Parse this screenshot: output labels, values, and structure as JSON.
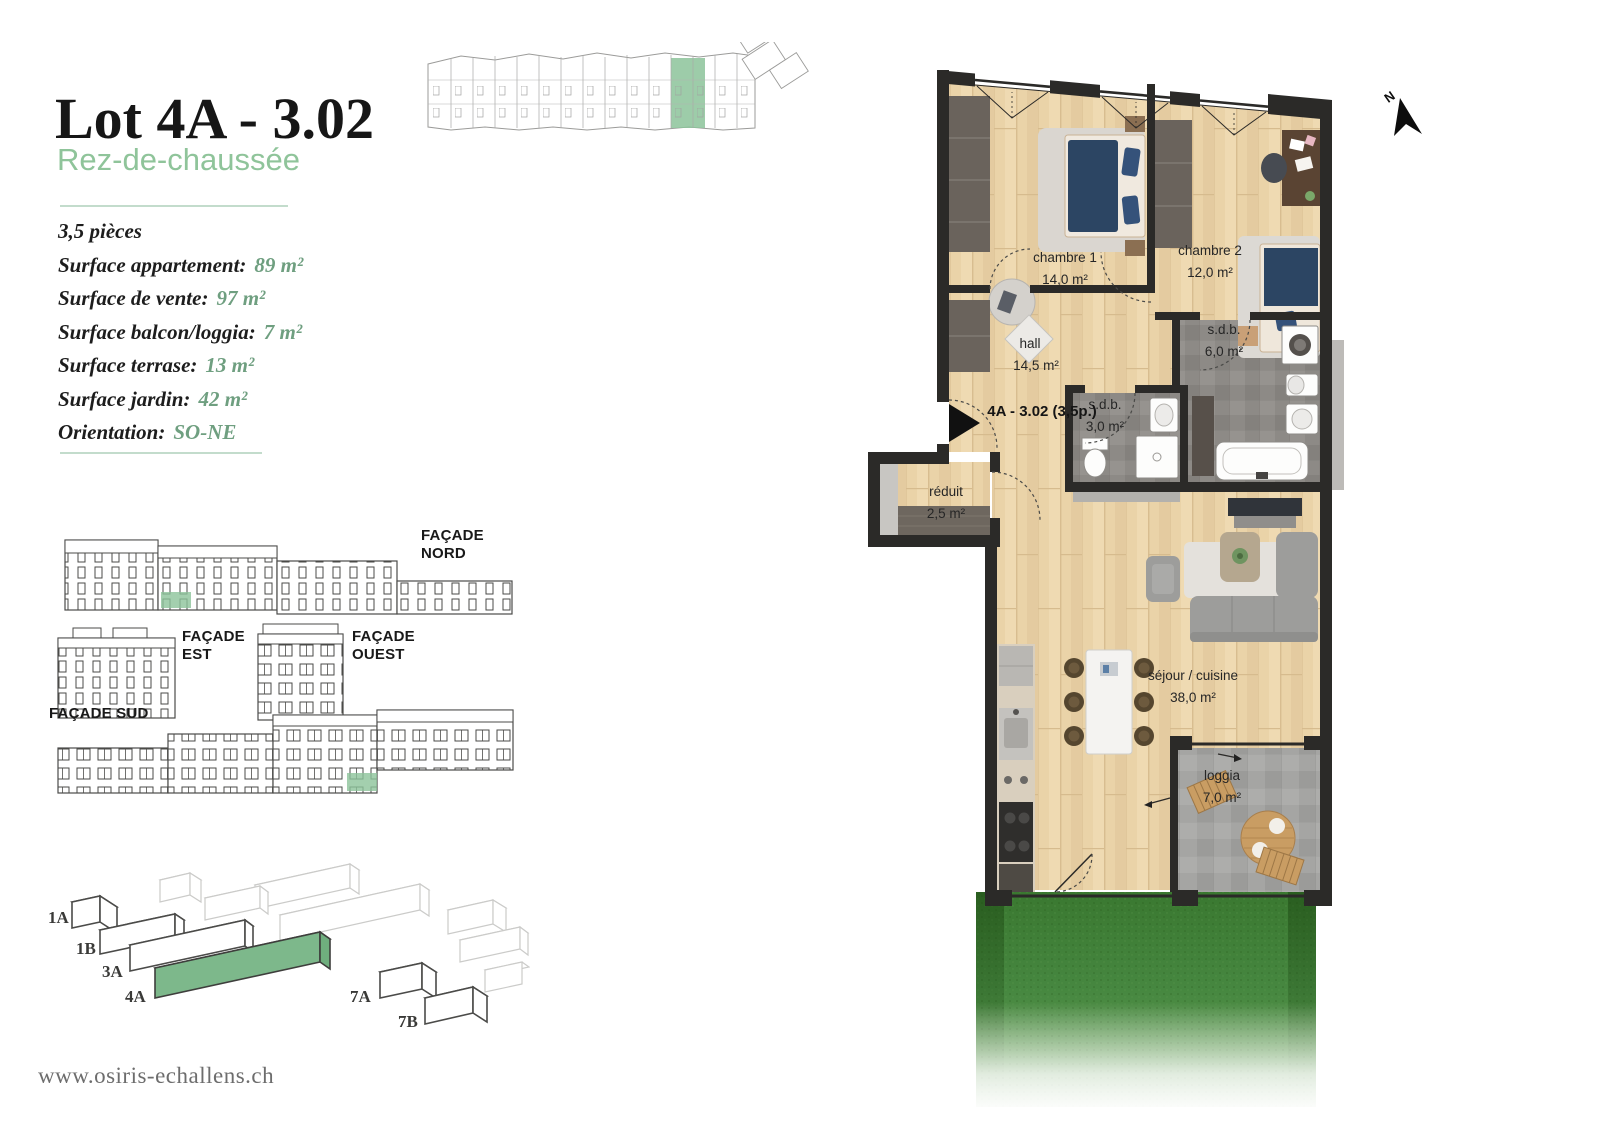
{
  "header": {
    "title": "Lot 4A - 3.02",
    "subtitle": "Rez-de-chaussée"
  },
  "details": {
    "pieces": "3,5 pièces",
    "items": [
      {
        "label": "Surface appartement:",
        "value": "89 m²"
      },
      {
        "label": "Surface de vente:",
        "value": "97 m²"
      },
      {
        "label": "Surface balcon/loggia:",
        "value": "7 m²"
      },
      {
        "label": "Surface terrase:",
        "value": "13 m²"
      },
      {
        "label": "Surface jardin:",
        "value": "42 m²"
      },
      {
        "label": "Orientation:",
        "value": "SO-NE"
      }
    ]
  },
  "facades": {
    "nord_label": "FAÇADE NORD",
    "est_label": "FAÇADE EST",
    "ouest_label": "FAÇADE OUEST",
    "sud_label": "FAÇADE SUD"
  },
  "site_plan": {
    "highlighted": "4A",
    "labels": {
      "b1a": "1A",
      "b1b": "1B",
      "b3a": "3A",
      "b4a": "4A",
      "b7a": "7A",
      "b7b": "7B"
    }
  },
  "floor_plan": {
    "north_label": "N",
    "unit_label": "4A - 3.02 (3,5p.)",
    "rooms": [
      {
        "name": "chambre 1",
        "area": "14,0 m²"
      },
      {
        "name": "chambre 2",
        "area": "12,0 m²"
      },
      {
        "name": "hall",
        "area": "14,5 m²"
      },
      {
        "name": "s.d.b.",
        "area": "6,0 m²"
      },
      {
        "name": "s.d.b.",
        "area": "3,0 m²"
      },
      {
        "name": "réduit",
        "area": "2,5 m²"
      },
      {
        "name": "séjour / cuisine",
        "area": "38,0 m²"
      },
      {
        "name": "loggia",
        "area": "7,0 m²"
      }
    ]
  },
  "footer": {
    "website": "www.osiris-echallens.ch"
  },
  "colors": {
    "accent_green": "#8fc49a",
    "value_green": "#6f9f80",
    "highlight_green": "#8cc39a",
    "wall": "#2b2a28",
    "wood": "#ead3a8",
    "grass": "#3f7b33"
  }
}
